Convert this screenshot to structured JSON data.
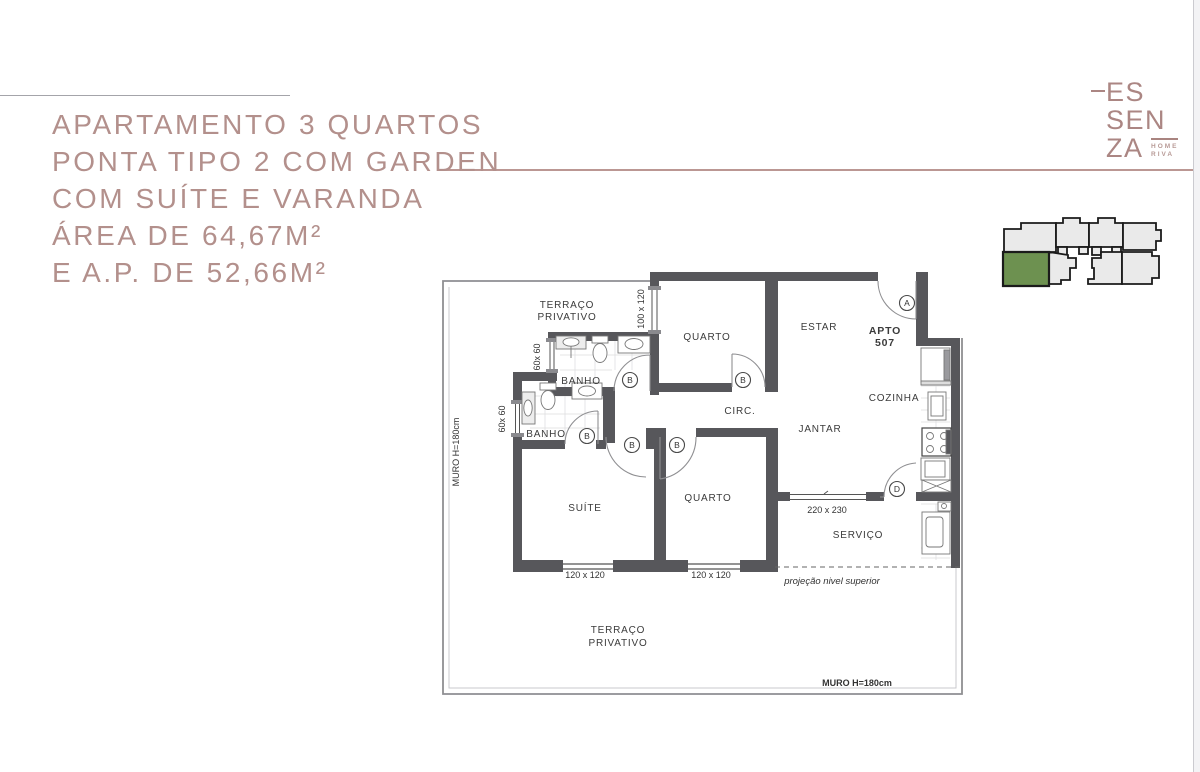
{
  "header": {
    "title_lines": [
      "APARTAMENTO 3 QUARTOS",
      "PONTA TIPO 2 COM GARDEN",
      "COM SUÍTE E VARANDA",
      "ÁREA DE 64,67M²",
      "E A.P. DE 52,66M²"
    ],
    "accent_color": "#b3908c"
  },
  "logo": {
    "line1": "ES",
    "line2": "SEN",
    "line3": "ZA",
    "sub1": "HOME",
    "sub2": "RIVA"
  },
  "key_plan": {
    "unit_fill": "#eaeaea",
    "outline": "#1b1b1b",
    "highlight_fill": "#6d9150",
    "highlighted_unit": "bottom-left"
  },
  "floor_plan": {
    "apto_label": "APTO",
    "apto_number": "507",
    "terrace_top_1": "TERRAÇO",
    "terrace_top_2": "PRIVATIVO",
    "terrace_bottom_1": "TERRAÇO",
    "terrace_bottom_2": "PRIVATIVO",
    "banho1": "BANHO",
    "banho2": "BANHO",
    "quarto1": "QUARTO",
    "quarto2": "QUARTO",
    "suite": "SUÍTE",
    "estar": "ESTAR",
    "jantar": "JANTAR",
    "cozinha": "COZINHA",
    "circ": "CIRC.",
    "servico": "SERVIÇO",
    "dim_window_quarto1": "100 x 120",
    "dim_window_banho1": "60x 60",
    "dim_window_banho2": "60x 60",
    "dim_window_suite": "120 x 120",
    "dim_window_quarto2": "120 x 120",
    "dim_door_varanda": "220 x 230",
    "muro_left": "MURO H=180cm",
    "muro_bottom": "MURO H=180cm",
    "projecao": "projeção nivel superior",
    "door_a": "A",
    "door_b": "B",
    "door_d": "D",
    "wall_color": "#57575b"
  }
}
